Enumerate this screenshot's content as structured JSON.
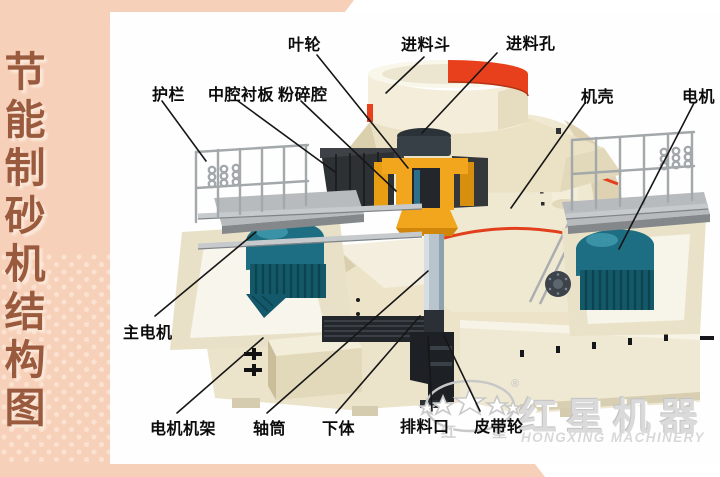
{
  "sidebar": {
    "title": "节能制砂机结构图"
  },
  "diagram": {
    "labels": [
      {
        "id": "impeller",
        "text": "叶轮"
      },
      {
        "id": "feed-hopper",
        "text": "进料斗"
      },
      {
        "id": "feed-hole",
        "text": "进料孔"
      },
      {
        "id": "guardrail",
        "text": "护栏"
      },
      {
        "id": "middle-cavity-liner",
        "text": "中腔衬板"
      },
      {
        "id": "crushing-cavity",
        "text": "粉碎腔"
      },
      {
        "id": "casing",
        "text": "机壳"
      },
      {
        "id": "motor",
        "text": "电机"
      },
      {
        "id": "main-motor",
        "text": "主电机"
      },
      {
        "id": "motor-frame",
        "text": "电机机架"
      },
      {
        "id": "shaft-tube",
        "text": "轴筒"
      },
      {
        "id": "lower-body",
        "text": "下体"
      },
      {
        "id": "discharge-port",
        "text": "排料口"
      },
      {
        "id": "belt-pulley",
        "text": "皮带轮"
      }
    ]
  },
  "watermark": {
    "brand_cn": "红星机器",
    "brand_en": "HONGXING MACHINERY",
    "oval_char_left": "红",
    "oval_char_right": "星",
    "registered_mark": "®"
  },
  "colors": {
    "frame_pink": "#f7d0b9",
    "sidebar_text_brown": "#9a5a3e",
    "machine_cream": "#efe8d2",
    "accent_red": "#e8401c",
    "impeller_yellow": "#f2a61d",
    "motor_teal": "#1d6e82",
    "watermark_gray": "#dadada",
    "label_black": "#0c0c0c"
  }
}
